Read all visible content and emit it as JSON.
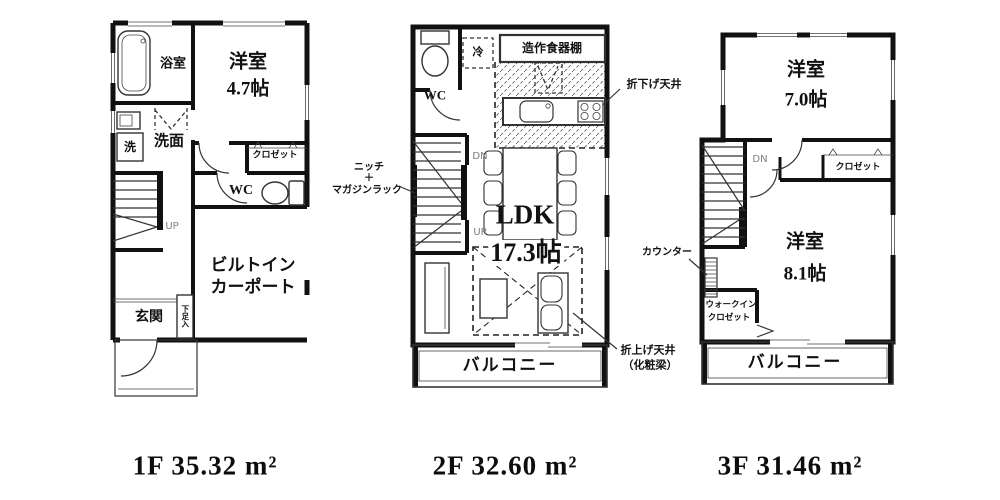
{
  "floors": [
    {
      "name": "1F",
      "area_label": "1F 35.32 m²",
      "labels": {
        "bathroom": "浴室",
        "room_name": "洋室",
        "room_size": "4.7帖",
        "washroom": "洗面",
        "washer": "洗",
        "closet": "クロゼット",
        "wc": "WC",
        "up": "UP",
        "carport_1": "ビルトイン",
        "carport_2": "カーポート",
        "entrance": "玄関",
        "shoe_cabinet": "下足入"
      }
    },
    {
      "name": "2F",
      "area_label": "2F 32.60 m²",
      "labels": {
        "wc": "WC",
        "fridge": "冷",
        "cupboard": "造作食器棚",
        "dropped_ceiling": "折下げ天井",
        "niche_1": "ニッチ",
        "niche_2": "＋",
        "niche_3": "マガジンラック",
        "dn": "DN",
        "up": "UP",
        "ldk_name": "LDK",
        "ldk_size": "17.3帖",
        "raised_ceiling_1": "折上げ天井",
        "raised_ceiling_2": "（化粧梁）",
        "balcony": "バルコニー"
      }
    },
    {
      "name": "3F",
      "area_label": "3F 31.46 m²",
      "labels": {
        "room7_name": "洋室",
        "room7_size": "7.0帖",
        "dn": "DN",
        "closet": "クロゼット",
        "counter": "カウンター",
        "room8_name": "洋室",
        "room8_size": "8.1帖",
        "wic_1": "ウォークイン",
        "wic_2": "クロゼット",
        "balcony": "バルコニー"
      }
    }
  ],
  "colors": {
    "wall": "#111111",
    "line": "#333333",
    "gray_label": "#7d7d85",
    "background": "#ffffff"
  }
}
